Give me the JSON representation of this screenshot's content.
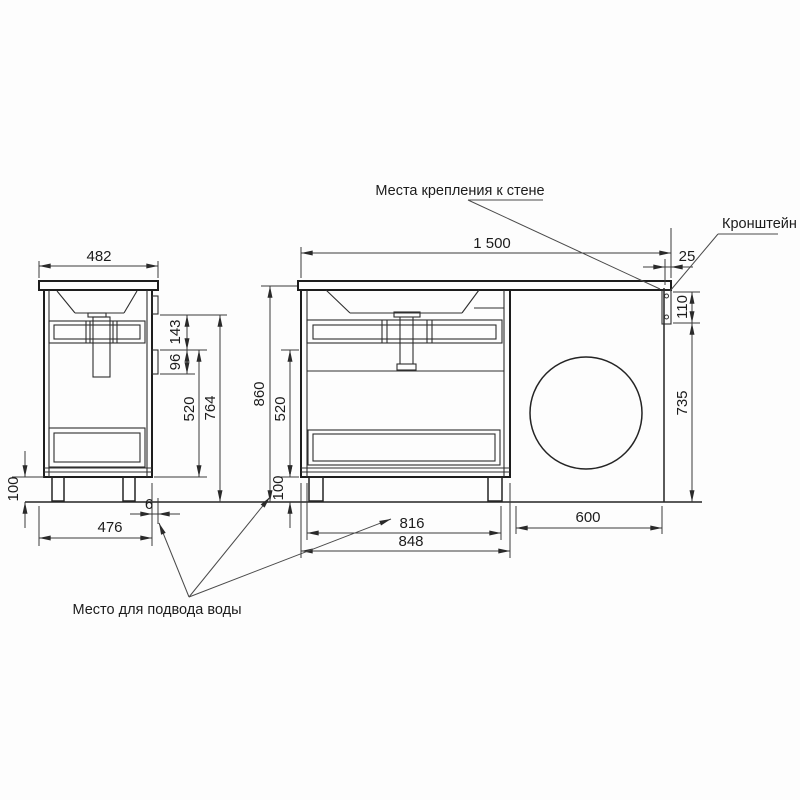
{
  "annotations": {
    "wall_mount": "Места крепления к стене",
    "bracket": "Кронштейн",
    "water_supply": "Место для подвода воды"
  },
  "side_view": {
    "dims": {
      "top_width": "482",
      "strip_spacing": "143",
      "strip_height": "96",
      "bottom_section": "520",
      "back_height": "764",
      "legs": "100",
      "depth": "476",
      "wall_gap": "6"
    }
  },
  "front_view": {
    "dims": {
      "total_width": "1 500",
      "edge_offset": "25",
      "bracket_height": "110",
      "niche_height": "735",
      "total_height": "860",
      "drawer_section": "520",
      "legs": "100",
      "inner_width": "816",
      "cabinet_width": "848",
      "niche_width": "600"
    }
  }
}
